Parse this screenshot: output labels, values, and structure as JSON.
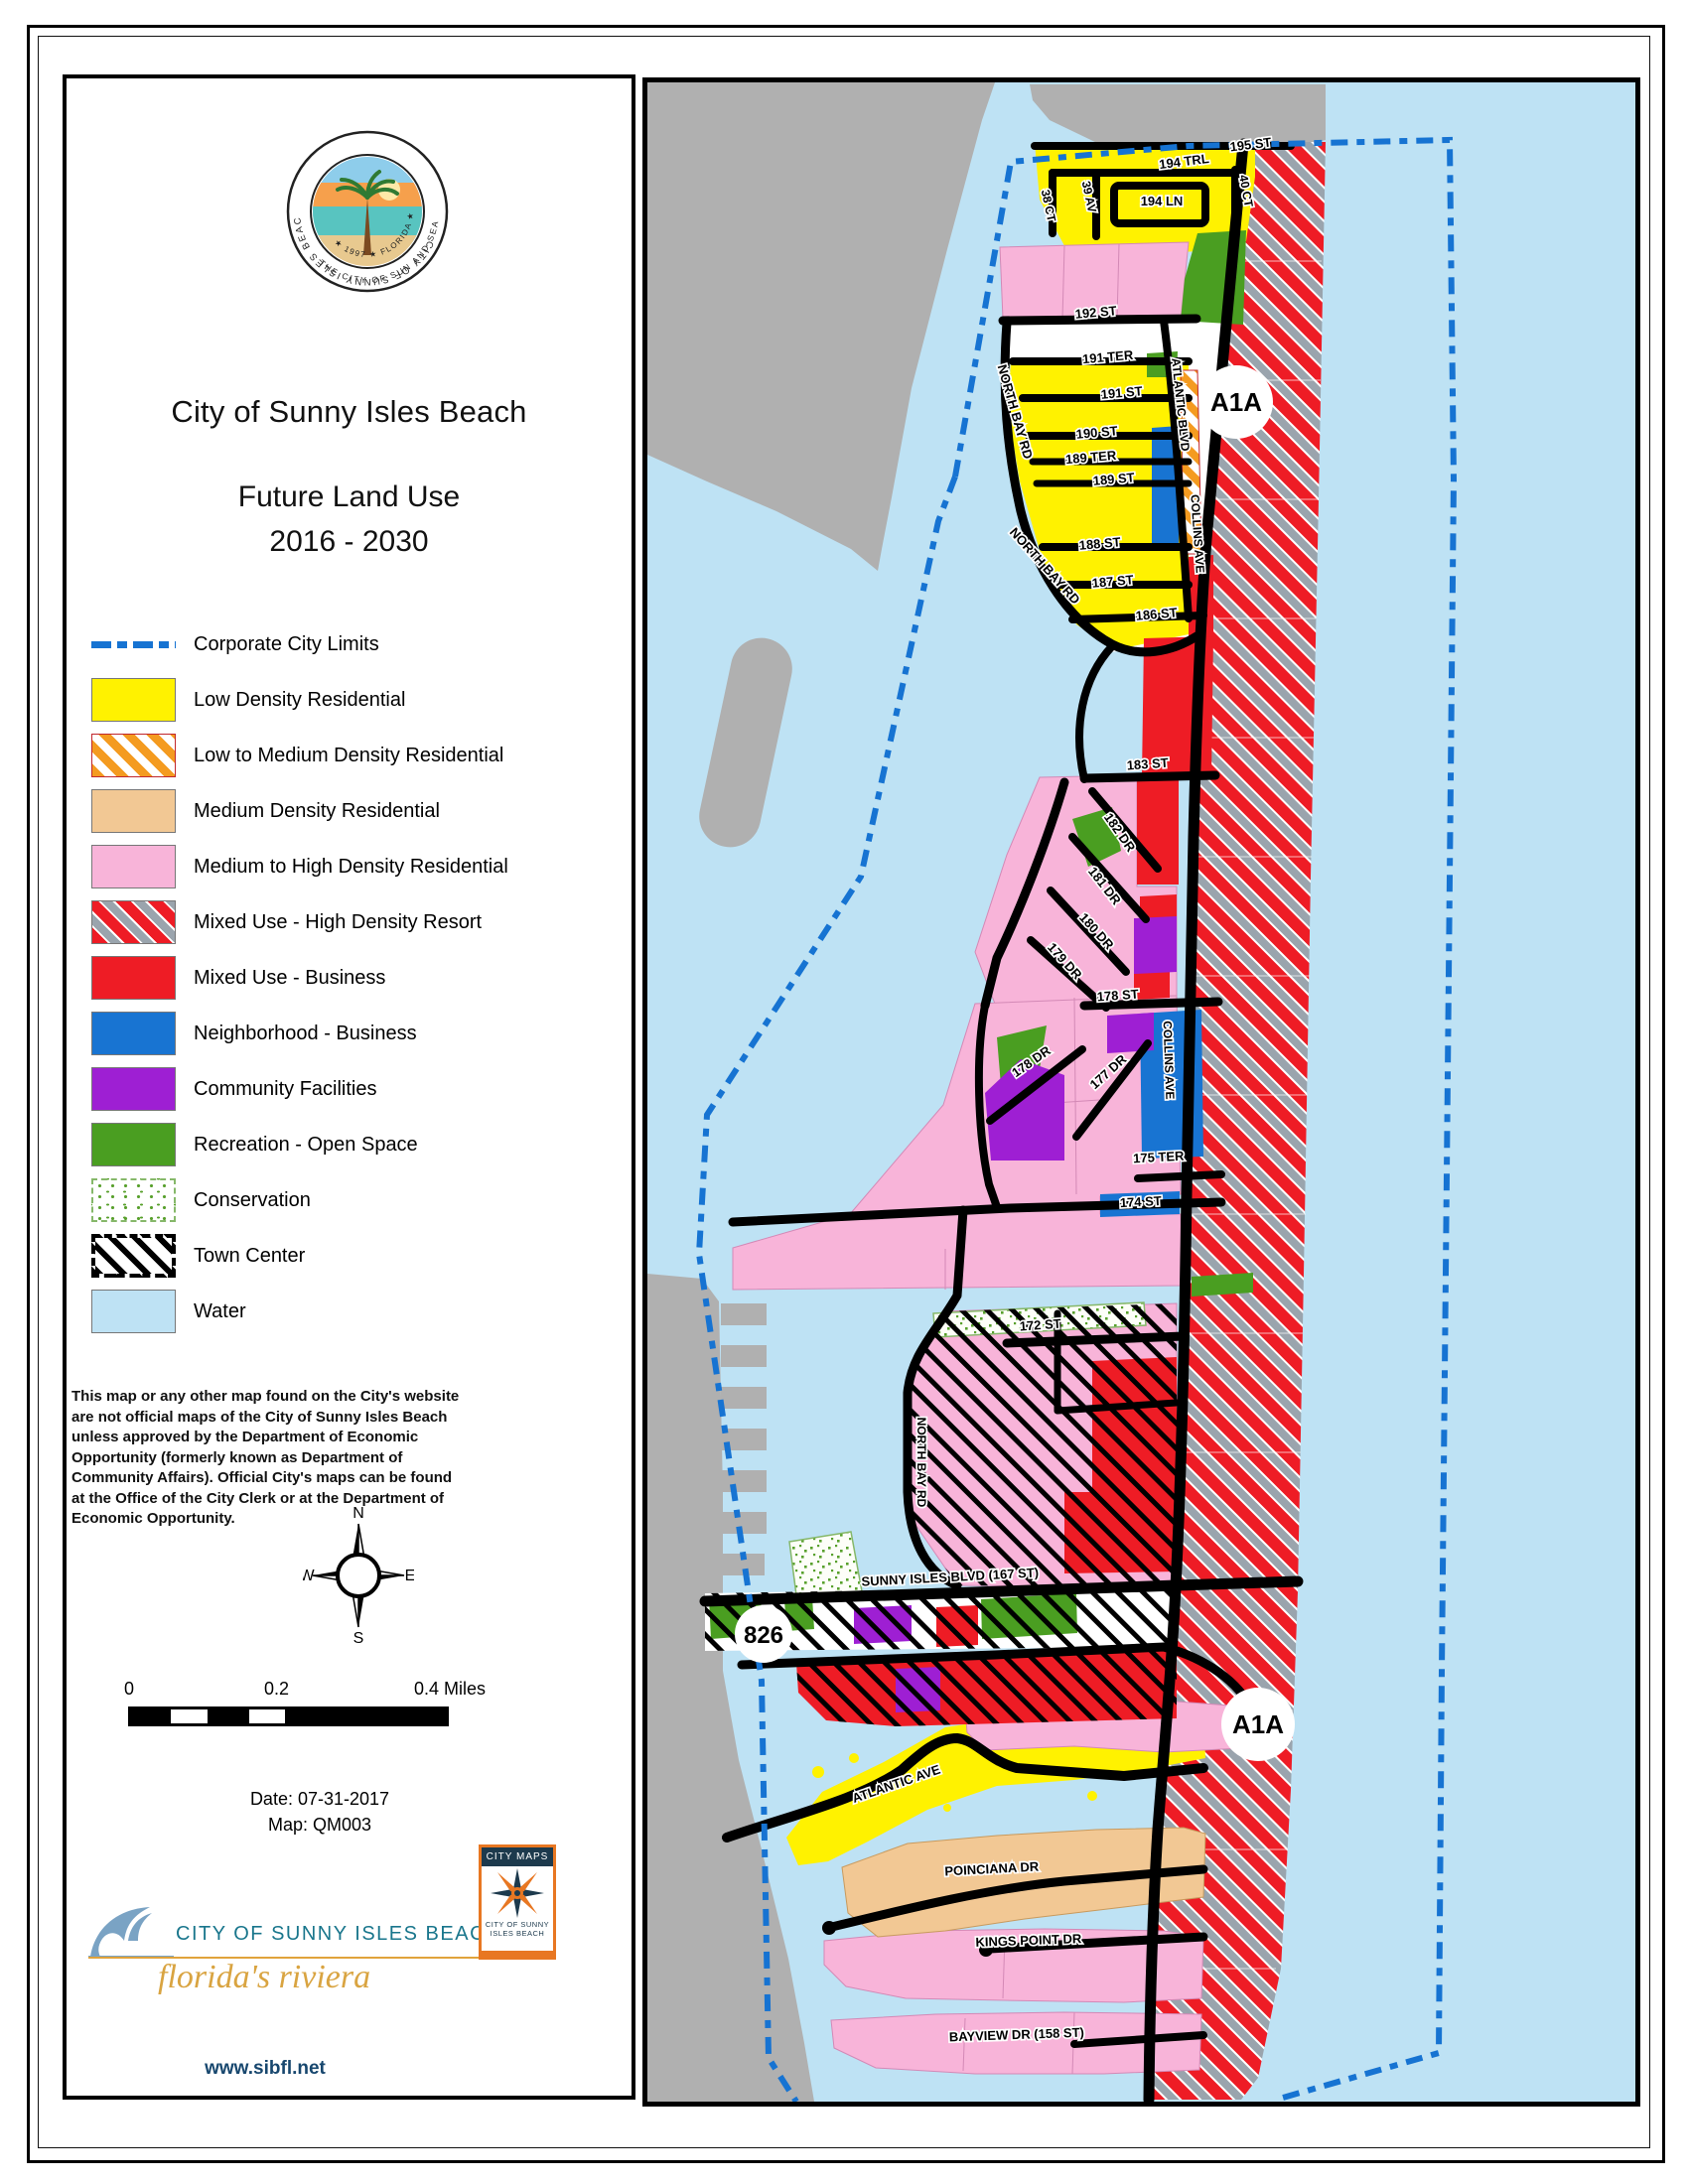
{
  "panel": {
    "title": "City of Sunny Isles Beach",
    "subtitle_line1": "Future Land Use",
    "subtitle_line2": "2016 - 2030",
    "seal": {
      "ring_top": "CITY OF SUNNY ISLES BEACH",
      "inner_bottom": "★ 1997 ★ FLORIDA ★",
      "ring_bottom": "THE CITY OF SUN AND SEA"
    },
    "legend": [
      {
        "label": "Corporate City Limits",
        "swatch": "dashed-blue-line",
        "color": "#1673D2"
      },
      {
        "label": "Low Density Residential",
        "swatch": "solid",
        "color": "#FFF200"
      },
      {
        "label": "Low to Medium Density Residential",
        "swatch": "orange-stripes",
        "color": "#F49B20"
      },
      {
        "label": "Medium Density Residential",
        "swatch": "solid",
        "color": "#F2C894"
      },
      {
        "label": "Medium to High Density Residential",
        "swatch": "solid",
        "color": "#F8B4D9"
      },
      {
        "label": "Mixed Use - High Density Resort",
        "swatch": "red-gray-stripes",
        "color": "#EE1C25"
      },
      {
        "label": "Mixed Use - Business",
        "swatch": "solid",
        "color": "#EE1C25"
      },
      {
        "label": "Neighborhood - Business",
        "swatch": "solid",
        "color": "#1874D2"
      },
      {
        "label": "Community Facilities",
        "swatch": "solid",
        "color": "#9E1FD3"
      },
      {
        "label": "Recreation - Open Space",
        "swatch": "solid",
        "color": "#4A9E21"
      },
      {
        "label": "Conservation",
        "swatch": "green-speckle",
        "color": "#58A02C"
      },
      {
        "label": "Town Center",
        "swatch": "black-hatch",
        "color": "#000000"
      },
      {
        "label": "Water",
        "swatch": "solid",
        "color": "#BEE2F4"
      }
    ],
    "disclaimer": "This map or any other map found on the City's website are not official maps of the City of Sunny Isles Beach unless approved by the Department of Economic Opportunity (formerly known as Department of Community Affairs). Official City's maps can be found at the Office of the City Clerk or at the Department of Economic Opportunity.",
    "compass": {
      "n": "N",
      "s": "S",
      "e": "E",
      "w": "W"
    },
    "scale": {
      "zero": "0",
      "mid": "0.2",
      "end": "0.4 Miles"
    },
    "date_line": "Date: 07-31-2017",
    "map_line": "Map: QM003",
    "brand": {
      "name": "CITY OF SUNNY ISLES BEACH",
      "tagline": "florida's riviera",
      "url": "www.sibfl.net"
    },
    "citymaps": {
      "title": "CITY MAPS",
      "org_line1": "CITY OF SUNNY",
      "org_line2": "ISLES  BEACH"
    }
  },
  "map": {
    "badges": [
      {
        "text": "A1A"
      },
      {
        "text": "826"
      },
      {
        "text": "A1A"
      }
    ],
    "labels": [
      {
        "text": "195 ST"
      },
      {
        "text": "194 TRL"
      },
      {
        "text": "194 LN"
      },
      {
        "text": "40 CT"
      },
      {
        "text": "39 AV"
      },
      {
        "text": "38 CT"
      },
      {
        "text": "192 ST"
      },
      {
        "text": "191 TER"
      },
      {
        "text": "191 ST"
      },
      {
        "text": "190 ST"
      },
      {
        "text": "189 TER"
      },
      {
        "text": "189 ST"
      },
      {
        "text": "188 ST"
      },
      {
        "text": "187 ST"
      },
      {
        "text": "186 ST"
      },
      {
        "text": "NORTH BAY RD"
      },
      {
        "text": "NORTH BAY RD"
      },
      {
        "text": "ATLANTIC BLVD"
      },
      {
        "text": "183 ST"
      },
      {
        "text": "182 DR"
      },
      {
        "text": "181 DR"
      },
      {
        "text": "180 DR"
      },
      {
        "text": "179 DR"
      },
      {
        "text": "178 ST"
      },
      {
        "text": "178 DR"
      },
      {
        "text": "177 DR"
      },
      {
        "text": "175 TER"
      },
      {
        "text": "174 ST"
      },
      {
        "text": "COLLINS AVE"
      },
      {
        "text": "COLLINS AVE"
      },
      {
        "text": "172 ST"
      },
      {
        "text": "NORTH BAY RD"
      },
      {
        "text": "SUNNY ISLES BLVD (167 ST)"
      },
      {
        "text": "ATLANTIC AVE"
      },
      {
        "text": "POINCIANA DR"
      },
      {
        "text": "KINGS POINT DR"
      },
      {
        "text": "BAYVIEW DR (158 ST)"
      }
    ],
    "colors": {
      "water": "#BEE2F4",
      "mainland": "#B0B0B0",
      "city_limits": "#1673D2",
      "road": "#000000"
    }
  }
}
